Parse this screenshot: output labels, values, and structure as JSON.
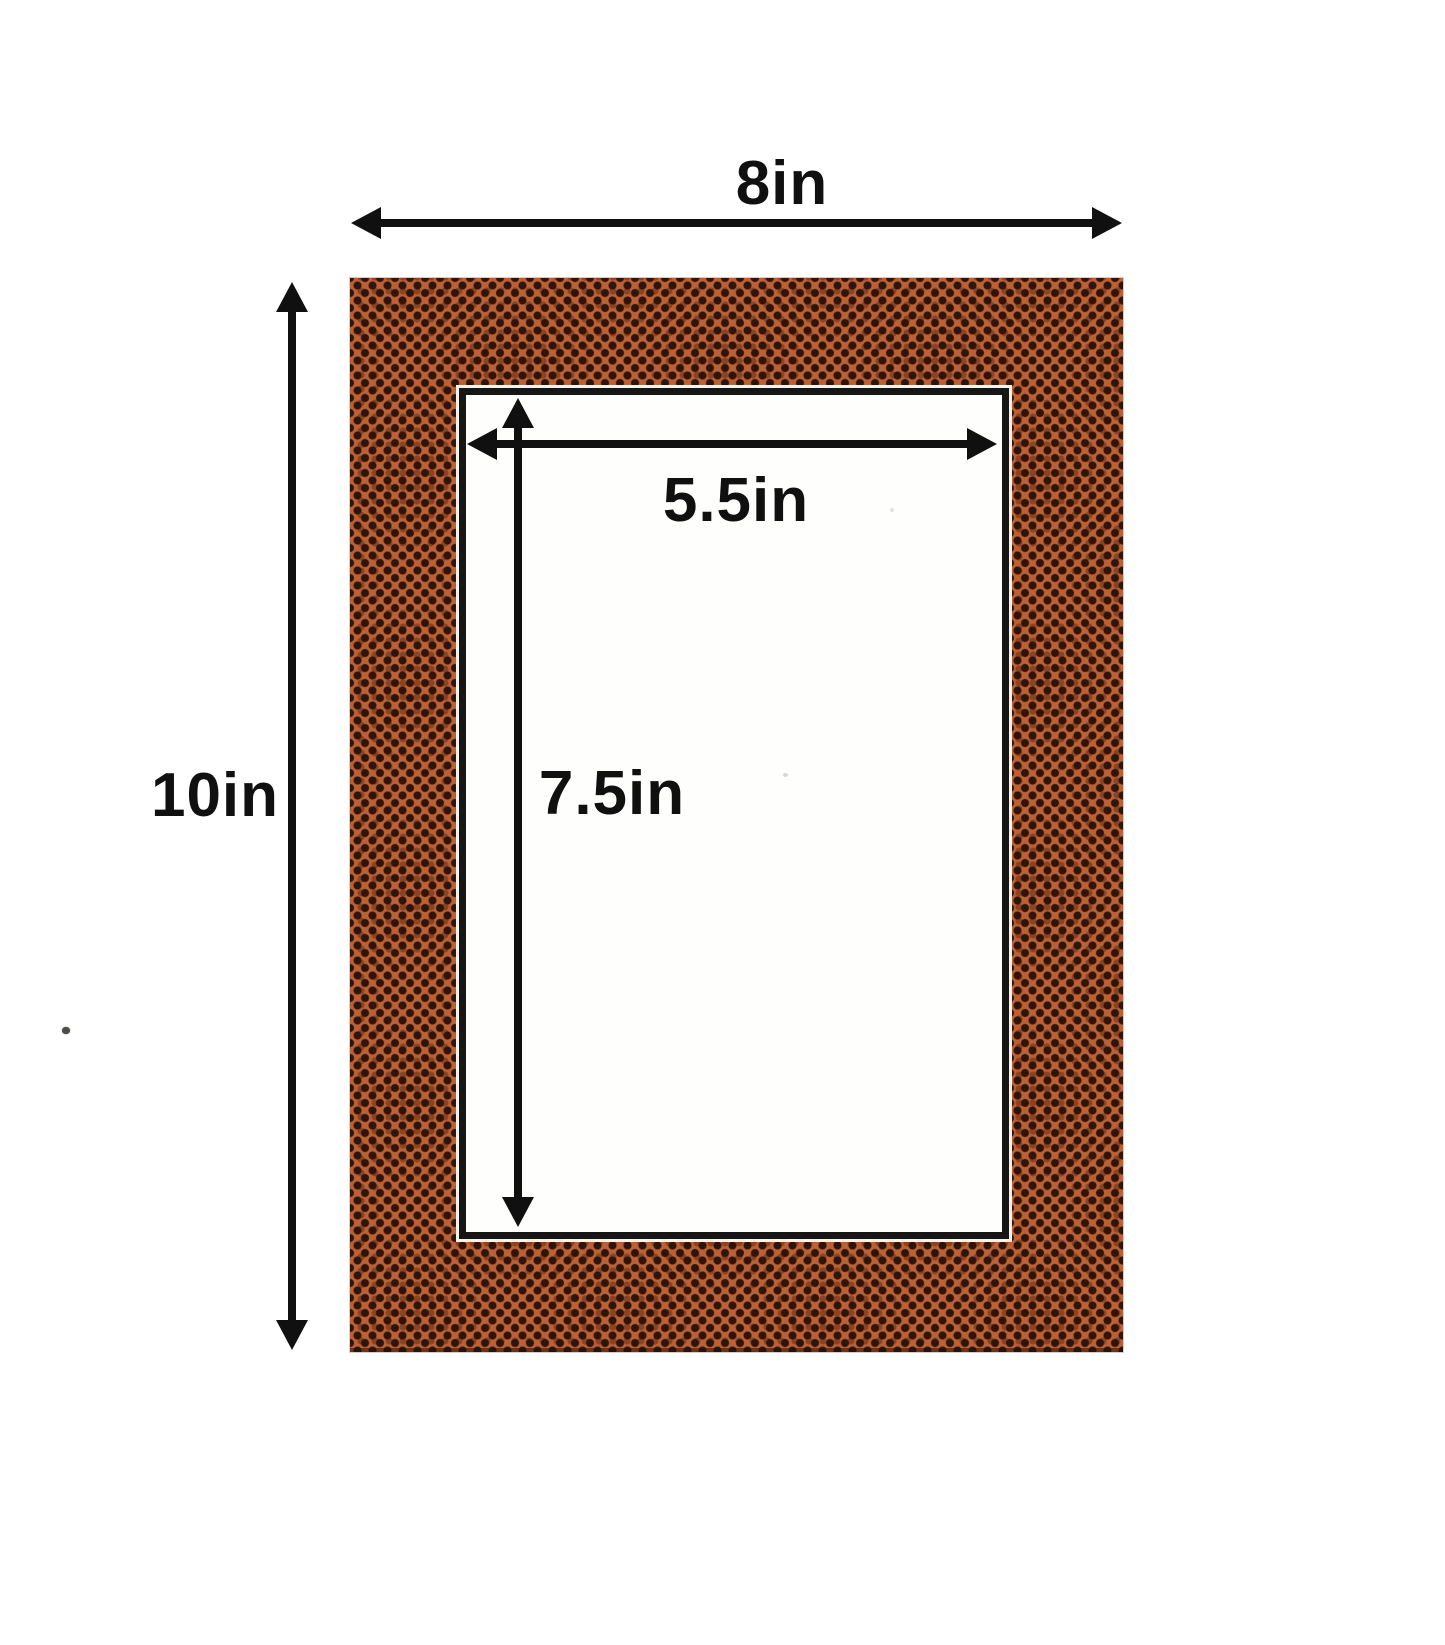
{
  "canvas": {
    "background": "#ffffff"
  },
  "mat": {
    "texture": "football-pebble-leather",
    "base_color": "#bc6136",
    "dot_color": "#2e1409",
    "bevel_line_color": "#161616",
    "opening_fill": "#fefefd"
  },
  "annotations": {
    "ink_color": "#101010",
    "outer_width_label": "8in",
    "outer_height_label": "10in",
    "opening_width_label": "5.5in",
    "opening_height_label": "7.5in"
  }
}
